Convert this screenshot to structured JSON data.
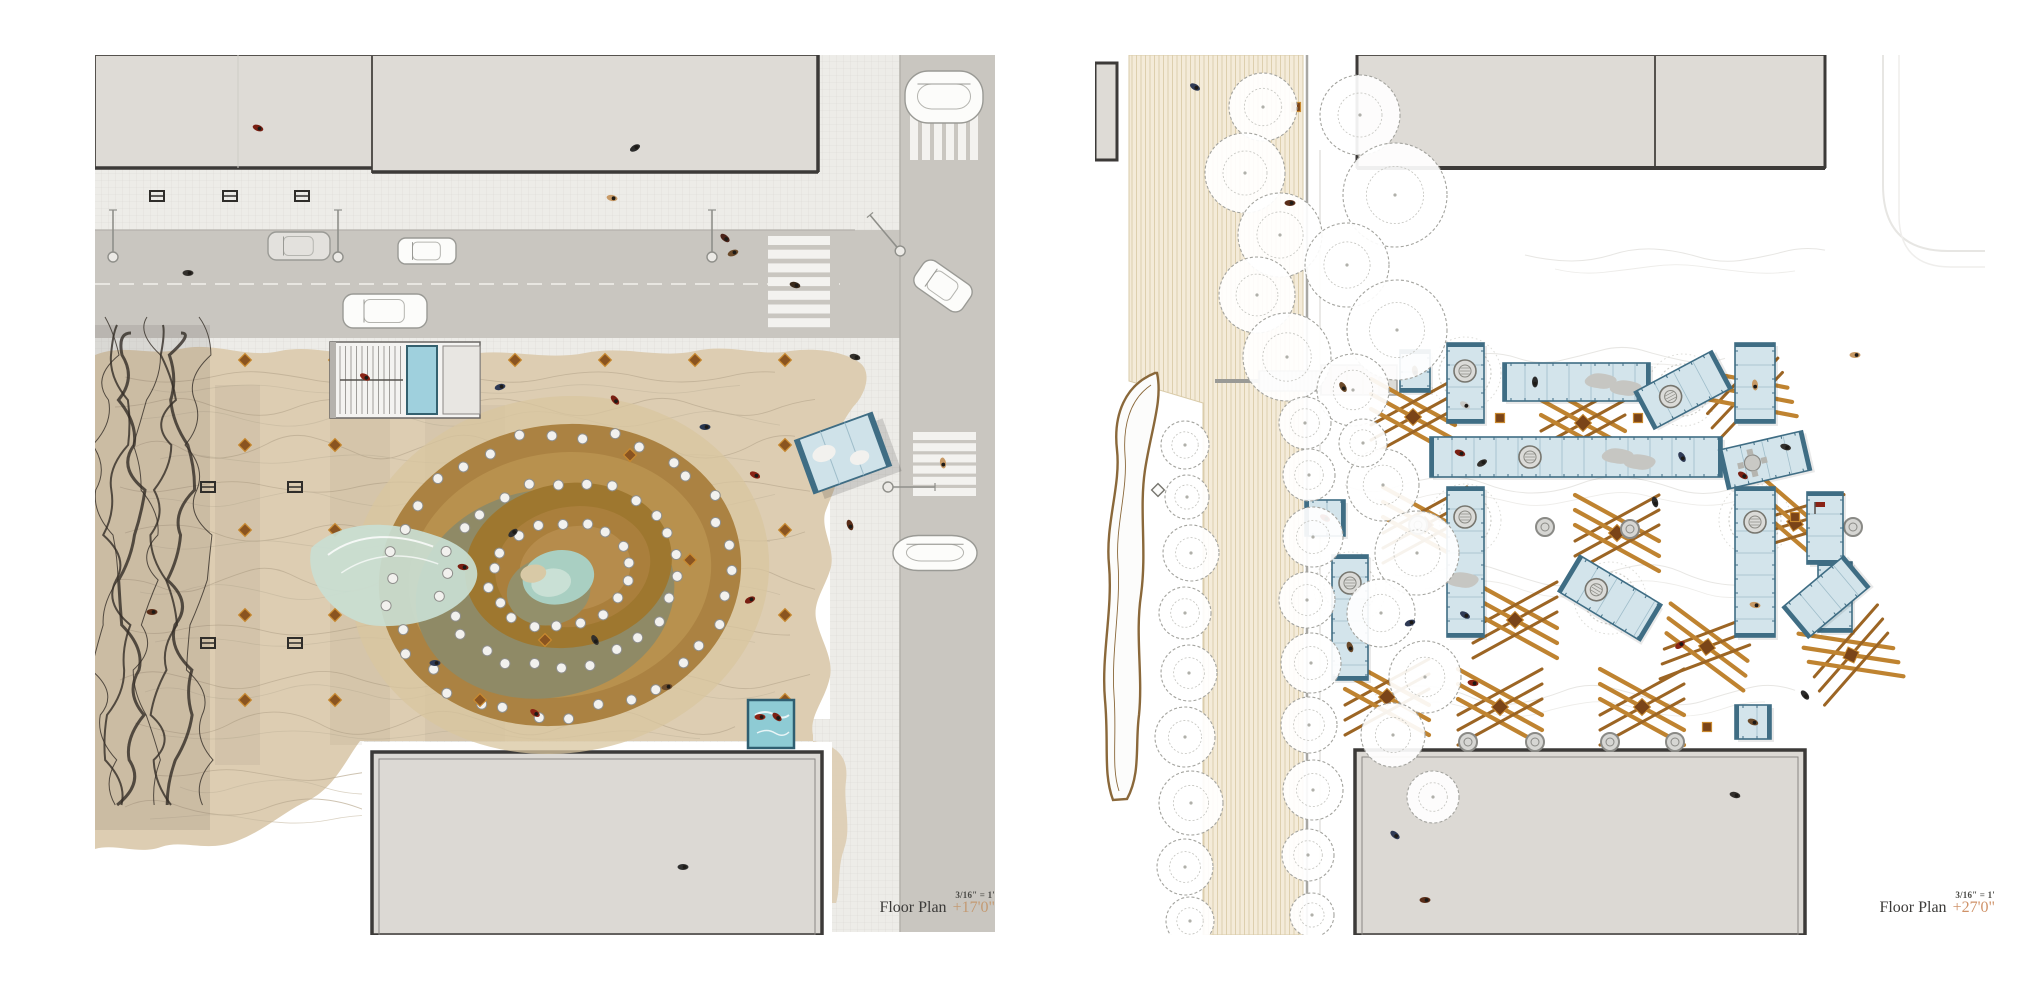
{
  "page": {
    "background": "#ffffff"
  },
  "left_plan": {
    "title": "Floor Plan",
    "elevation": "+17'0\"",
    "scale": "3/16\" = 1'"
  },
  "right_plan": {
    "title": "Floor Plan",
    "elevation": "+27'0\"",
    "scale": "3/16\" = 1'"
  },
  "palette": {
    "site_tan": "#ddcdb2",
    "contour_line": "#b9aa90",
    "mound_brown_outer": "#ab8242",
    "mound_brown_mid": "#b8914e",
    "mound_brown_dark": "#9e772f",
    "mound_olive": "#8f8a66",
    "pond_green": "#a9cfc2",
    "lagoon_blue": "#c9ded3",
    "street_gray": "#c9c6c0",
    "sidewalk_gray": "#edece8",
    "building_gray": "#dedbd6",
    "building_outline": "#3c3a38",
    "glass_blue": "#d3e4eb",
    "glass_frame": "#3f6d84",
    "timber_orange": "#bf8330",
    "timber_dark": "#9c6524",
    "boardwalk_cream": "#f4ebd9",
    "pool_blue": "#8ecbd4",
    "marker_brown": "#7a4418",
    "left_elevation_text": "#c49a72",
    "right_elevation_text": "#cf9268",
    "title_text": "#3b3a38"
  }
}
